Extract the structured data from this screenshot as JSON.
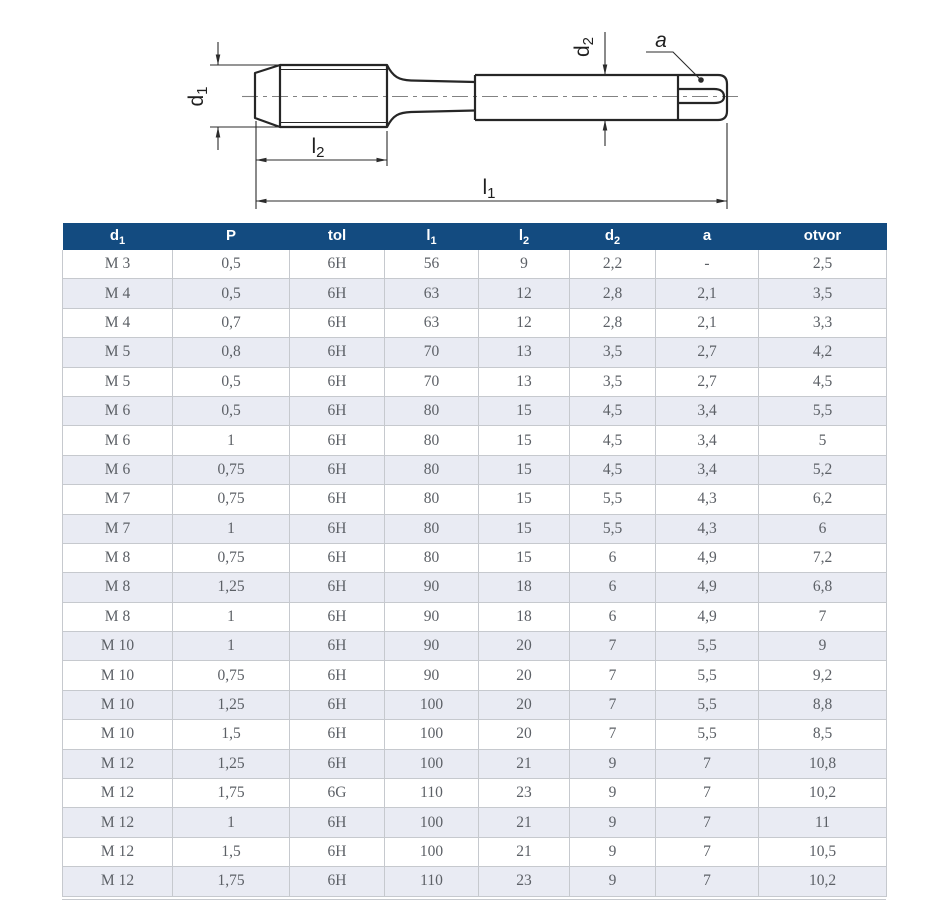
{
  "page": {
    "background": "#ffffff",
    "description_name": "tap-dimension-spec-sheet"
  },
  "drawing": {
    "name": "hand-tap-technical-drawing",
    "line_color": "#262626",
    "centerline_color": "#828282",
    "labels": {
      "d1_base": "d",
      "d1_sub": "1",
      "l2_base": "l",
      "l2_sub": "2",
      "l1_base": "l",
      "l1_sub": "1",
      "d2_base": "d",
      "d2_sub": "2",
      "a": "a"
    }
  },
  "table": {
    "header_bg": "#134b80",
    "header_text_color": "#ffffff",
    "row_bg": "#ffffff",
    "row_alt_bg": "#e9ebf3",
    "border_color": "#c6c9ce",
    "cell_text_color": "#5c6066",
    "columns": [
      {
        "base": "d",
        "sub": "1"
      },
      {
        "base": "P",
        "sub": ""
      },
      {
        "base": "tol",
        "sub": ""
      },
      {
        "base": "l",
        "sub": "1"
      },
      {
        "base": "l",
        "sub": "2"
      },
      {
        "base": "d",
        "sub": "2"
      },
      {
        "base": "a",
        "sub": ""
      },
      {
        "base": "otvor",
        "sub": ""
      }
    ],
    "rows": [
      [
        "M 3",
        "0,5",
        "6H",
        "56",
        "9",
        "2,2",
        "-",
        "2,5"
      ],
      [
        "M 4",
        "0,5",
        "6H",
        "63",
        "12",
        "2,8",
        "2,1",
        "3,5"
      ],
      [
        "M 4",
        "0,7",
        "6H",
        "63",
        "12",
        "2,8",
        "2,1",
        "3,3"
      ],
      [
        "M 5",
        "0,8",
        "6H",
        "70",
        "13",
        "3,5",
        "2,7",
        "4,2"
      ],
      [
        "M 5",
        "0,5",
        "6H",
        "70",
        "13",
        "3,5",
        "2,7",
        "4,5"
      ],
      [
        "M 6",
        "0,5",
        "6H",
        "80",
        "15",
        "4,5",
        "3,4",
        "5,5"
      ],
      [
        "M 6",
        "1",
        "6H",
        "80",
        "15",
        "4,5",
        "3,4",
        "5"
      ],
      [
        "M 6",
        "0,75",
        "6H",
        "80",
        "15",
        "4,5",
        "3,4",
        "5,2"
      ],
      [
        "M 7",
        "0,75",
        "6H",
        "80",
        "15",
        "5,5",
        "4,3",
        "6,2"
      ],
      [
        "M 7",
        "1",
        "6H",
        "80",
        "15",
        "5,5",
        "4,3",
        "6"
      ],
      [
        "M 8",
        "0,75",
        "6H",
        "80",
        "15",
        "6",
        "4,9",
        "7,2"
      ],
      [
        "M 8",
        "1,25",
        "6H",
        "90",
        "18",
        "6",
        "4,9",
        "6,8"
      ],
      [
        "M 8",
        "1",
        "6H",
        "90",
        "18",
        "6",
        "4,9",
        "7"
      ],
      [
        "M 10",
        "1",
        "6H",
        "90",
        "20",
        "7",
        "5,5",
        "9"
      ],
      [
        "M 10",
        "0,75",
        "6H",
        "90",
        "20",
        "7",
        "5,5",
        "9,2"
      ],
      [
        "M 10",
        "1,25",
        "6H",
        "100",
        "20",
        "7",
        "5,5",
        "8,8"
      ],
      [
        "M 10",
        "1,5",
        "6H",
        "100",
        "20",
        "7",
        "5,5",
        "8,5"
      ],
      [
        "M 12",
        "1,25",
        "6H",
        "100",
        "21",
        "9",
        "7",
        "10,8"
      ],
      [
        "M 12",
        "1,75",
        "6G",
        "110",
        "23",
        "9",
        "7",
        "10,2"
      ],
      [
        "M 12",
        "1",
        "6H",
        "100",
        "21",
        "9",
        "7",
        "11"
      ],
      [
        "M 12",
        "1,5",
        "6H",
        "100",
        "21",
        "9",
        "7",
        "10,5"
      ],
      [
        "M 12",
        "1,75",
        "6H",
        "110",
        "23",
        "9",
        "7",
        "10,2"
      ]
    ]
  }
}
